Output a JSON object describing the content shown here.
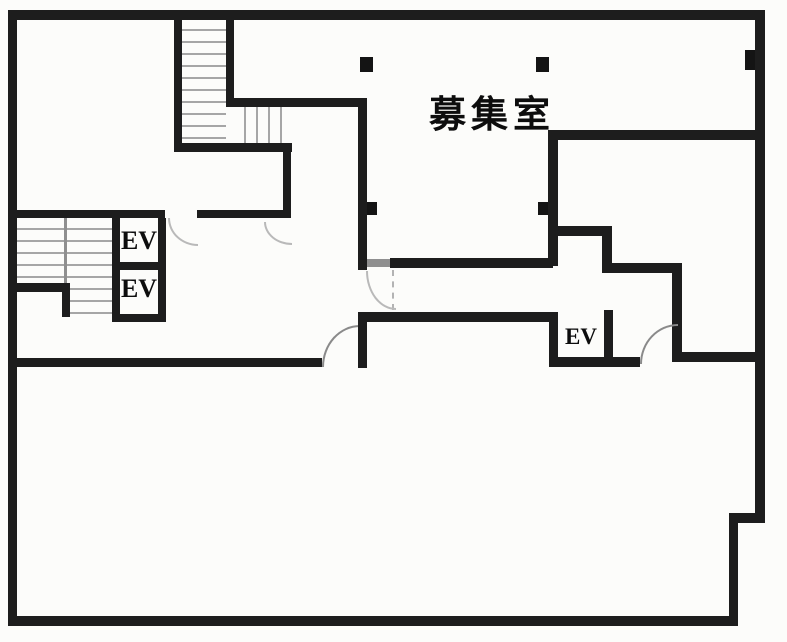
{
  "plan": {
    "kind": "building-floor-plan",
    "labels": {
      "main_room": "募集室",
      "elevator_left_upper": "EV",
      "elevator_left_lower": "EV",
      "elevator_right": "EV"
    },
    "colors": {
      "wall": "#1d1d1d",
      "background": "#fcfcfa",
      "stair_tread": "#a6a6a6",
      "door_arc": "#8a8a8a"
    }
  }
}
